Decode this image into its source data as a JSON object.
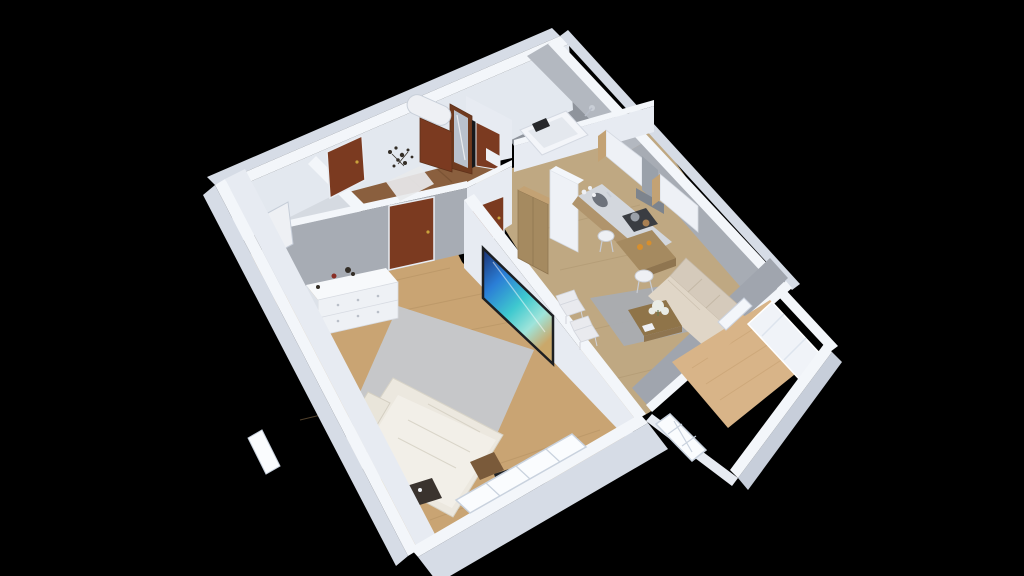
{
  "view": {
    "type": "3d-isometric-floorplan-render",
    "background": "#000000",
    "camera": "elevated south-east bird's eye"
  },
  "rooms": [
    {
      "name": "Entry hallway",
      "floor": "dark walnut",
      "items": [
        "entrance-door",
        "wardrobe-with-mirror",
        "bathroom-door",
        "decor-branches",
        "white-doormat",
        "water-heater"
      ]
    },
    {
      "name": "Closet",
      "floor": "light gray",
      "items": [
        "open-white-door"
      ]
    },
    {
      "name": "Bathroom",
      "floor": "gray tile",
      "items": [
        "bathtub",
        "shower-head",
        "washing-machine"
      ]
    },
    {
      "name": "Bedroom",
      "floor": "oak plank",
      "items": [
        "double-bed",
        "pillows",
        "area-rug",
        "white-dresser",
        "wall-tv",
        "gold-floor-lamp",
        "dark-nightstand",
        "desk",
        "black-chair",
        "window"
      ]
    },
    {
      "name": "Living room + kitchen",
      "floor": "oak plank",
      "items": [
        "tall-wood-cabinet",
        "tall-white-cabinet",
        "upper-cabinets",
        "range-hood",
        "cooktop",
        "sink",
        "counter",
        "bar-table",
        "bar-stools",
        "sofa",
        "coffee-table",
        "flowers",
        "area-rug",
        "dining-chairs"
      ]
    },
    {
      "name": "Balcony",
      "floor": "light oak",
      "items": [
        "balcony-door",
        "window-panels",
        "lattice-window"
      ]
    }
  ],
  "colors": {
    "background": "#000000",
    "wall_top": "#f3f6fa",
    "wall_white_face": "#e7ebf2",
    "wall_inner_light": "#e3e8ef",
    "wall_outer_face": "#d6dce6",
    "wall_outer_dark": "#c7ceda",
    "concrete_light": "#b3b8c0",
    "concrete": "#a7acb4",
    "concrete_dark": "#a0a5ae",
    "floor_entry": "#8a5f3e",
    "floor_entry_dark": "#6f4a2d",
    "floor_oak": "#c9a473",
    "floor_oak_stroke": "#b08d5f",
    "floor_living": "#bfa882",
    "floor_living_stroke": "#a8906a",
    "floor_balcony": "#d8b488",
    "floor_balcony_stroke": "#c49d6e",
    "floor_closet": "#d5dae1",
    "floor_bath": "#8f949c",
    "door_wood": "#7b3a20",
    "door_wood_dark": "#6f3a1f",
    "door_handle": "#c9a23c",
    "mirror": "#b9c1cd",
    "dark_gap": "#17181b",
    "white_goods": "#eef0f4",
    "tub_white": "#f3f5f9",
    "tub_inner": "#e4e8ee",
    "headrest": "#27282b",
    "fixture_gray": "#c9ced6",
    "rug_bedroom": "#c6c9cd",
    "rug_living": "#a8acb3",
    "bed_base": "#ece8df",
    "bed_blanket": "#f2efe8",
    "pillow": "#e9e5da",
    "pillow_line": "#d4cfc2",
    "dresser_front": "#eef1f5",
    "dresser_top": "#f7f9fb",
    "dresser_side": "#dde2e9",
    "knob": "#b9bfc8",
    "decor_dark": "#332d26",
    "decor_red": "#8a2f26",
    "tv_frame": "#1d1f22",
    "lamp_gold": "#c9a23c",
    "lamp_gold_light": "#e3c66a",
    "nightstand_dark": "#3a332e",
    "chair_black": "#1f2124",
    "desk_brown": "#7a5a3a",
    "sofa": "#d5cabb",
    "sofa_seat": "#e0d6c7",
    "sofa_line": "#c4b8a6",
    "wood_furn": "#a58a60",
    "wood_furn_dark": "#8f7550",
    "coffee_table": "#8f7449",
    "flower_white": "#e9ece6",
    "flower_stem": "#6a7a52",
    "chair_white": "#e9eaee",
    "stool_white": "#eef0f4",
    "cabinet_white": "#eef1f6",
    "cabinet_wood": "#c3a274",
    "hood_steel": "#9aa1aa",
    "hood_dark": "#7d848d",
    "counter_top": "#d3d7dd",
    "counter_front": "#b0946c",
    "sink_dark": "#6d727b",
    "cooktop": "#3a3d42",
    "pot_steel": "#9aa0a8",
    "pot_copper": "#a87f52",
    "glass_amber": "#d78f2e",
    "window_glass": "#fafcfe",
    "window_frame": "#c9d2de",
    "window_panel": "#f0f3f8",
    "mat_white": "#e8e9ec",
    "tv_screen_sky": "#2a63c8",
    "tv_screen_sea": "#35b9d4",
    "tv_screen_sand": "#d9c49a"
  }
}
